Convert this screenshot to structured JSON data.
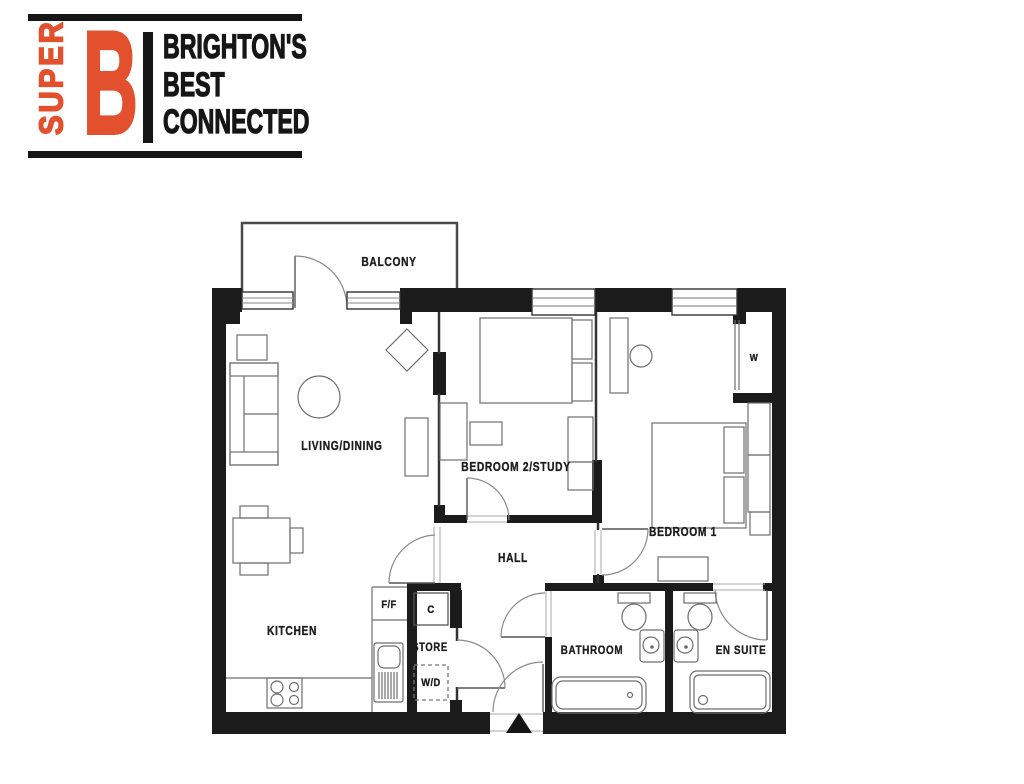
{
  "logo": {
    "vertical_text": "SUPER",
    "big_letter": "B",
    "tagline": {
      "line1": "BRIGHTON'S",
      "line2": "BEST",
      "line3": "CONNECTED"
    },
    "colors": {
      "orange": "#E2502E",
      "black": "#161616"
    }
  },
  "floor_plan": {
    "wall_color": "#1b1b1b",
    "furniture_line_color": "#6e6e6e",
    "labels": {
      "balcony": "BALCONY",
      "living_dining": "LIVING/DINING",
      "bedroom2": "BEDROOM 2/STUDY",
      "bedroom1": "BEDROOM 1",
      "hall": "HALL",
      "kitchen": "KITCHEN",
      "bathroom": "BATHROOM",
      "en_suite": "EN SUITE",
      "store": "STORE",
      "fridge_freezer": "F/F",
      "cupboard": "C",
      "washer_dryer": "W/D",
      "wardrobe": "W"
    }
  }
}
